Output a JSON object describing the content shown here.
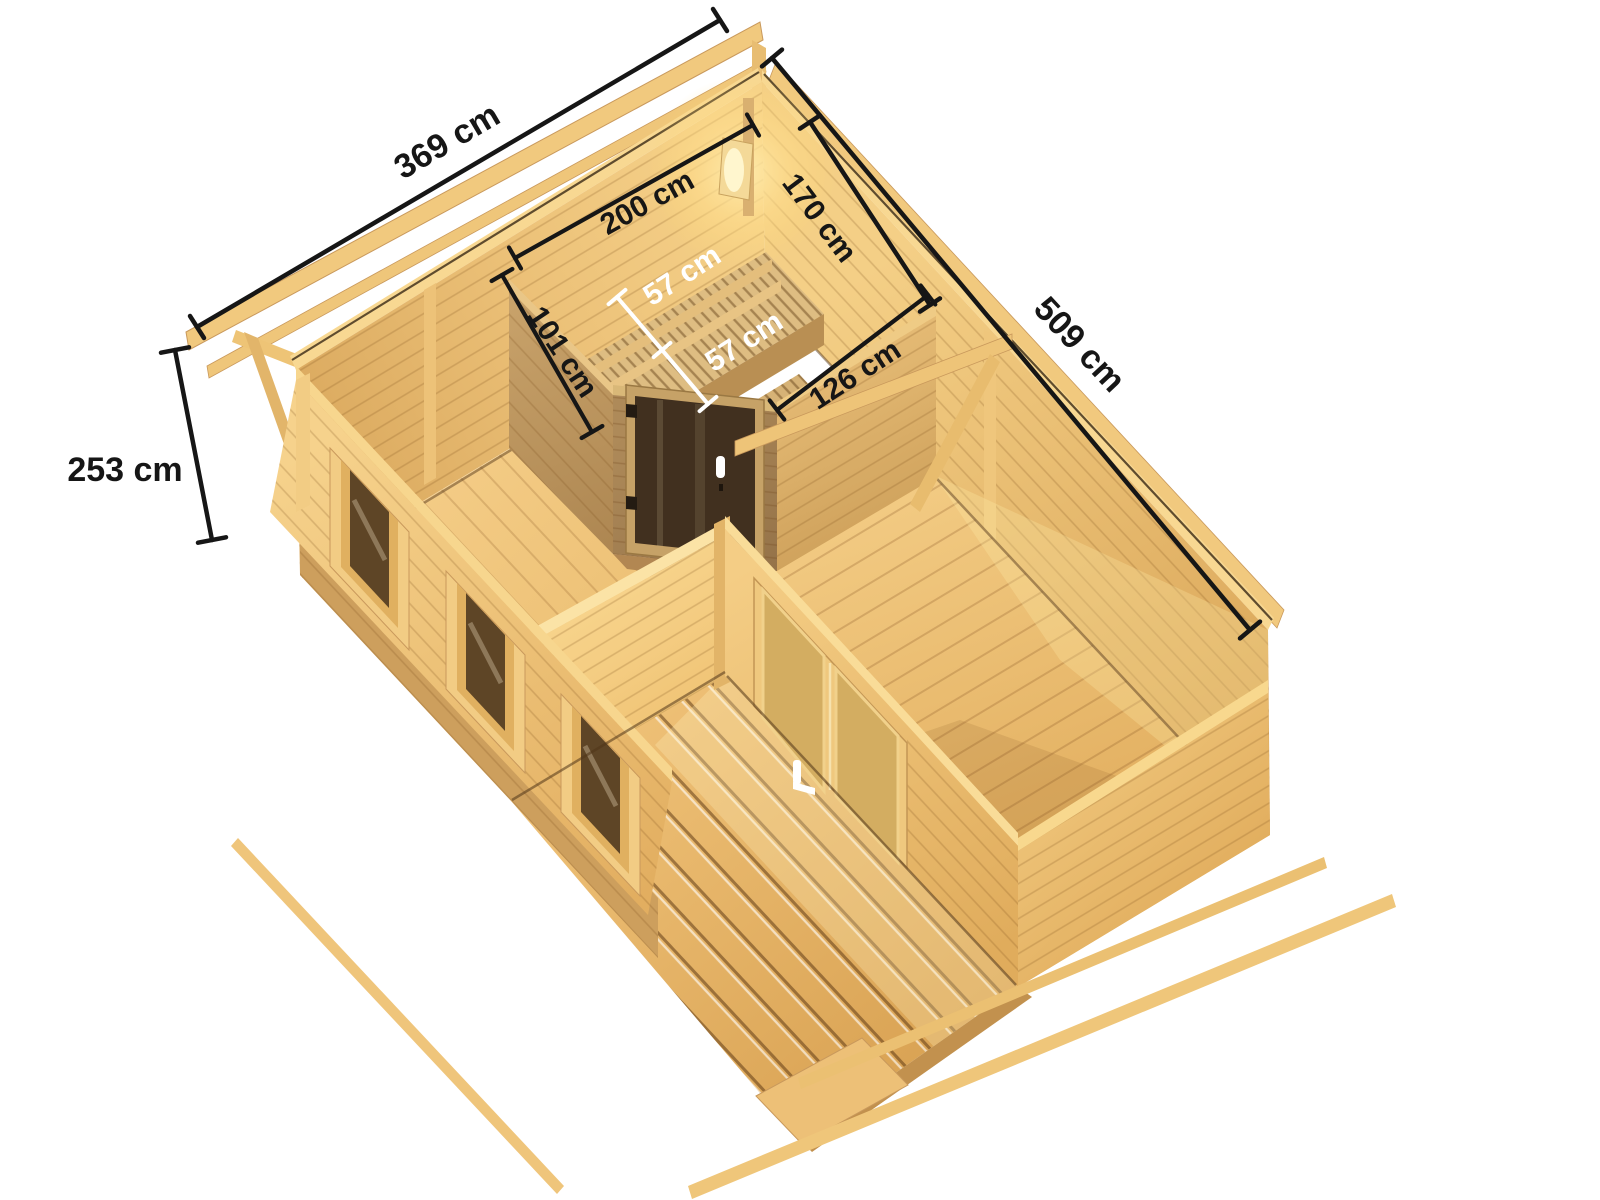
{
  "product": {
    "type": "log-cabin sauna house top view rendering",
    "rooms": [
      "sauna room",
      "main room",
      "terrace"
    ],
    "features": [
      "corner sauna cabin with bronze glass door",
      "two-tier benches",
      "corner lamp",
      "double glass door",
      "three windows",
      "plank terrace deck",
      "roof purlins"
    ]
  },
  "dimensions": {
    "total_width": {
      "label": "369 cm"
    },
    "total_depth": {
      "label": "509 cm"
    },
    "wall_height": {
      "label": "253 cm"
    },
    "sauna_width": {
      "label": "200 cm"
    },
    "sauna_depth": {
      "label": "170 cm"
    },
    "sauna_side_wall": {
      "label": "101 cm"
    },
    "sauna_front_wall": {
      "label": "126 cm"
    },
    "bench_upper": {
      "label": "57 cm"
    },
    "bench_lower": {
      "label": "57 cm"
    }
  },
  "colors": {
    "background": "#ffffff",
    "dimension_line": "#161616",
    "dimension_text_dark": "#161616",
    "dimension_text_light": "#ffffff",
    "wood_bright": "#F6D28C",
    "wood_light": "#F2CA80",
    "wood_mid": "#E2AE60",
    "wood_shadow": "#B28A54",
    "sauna_glass": "#41301F"
  }
}
